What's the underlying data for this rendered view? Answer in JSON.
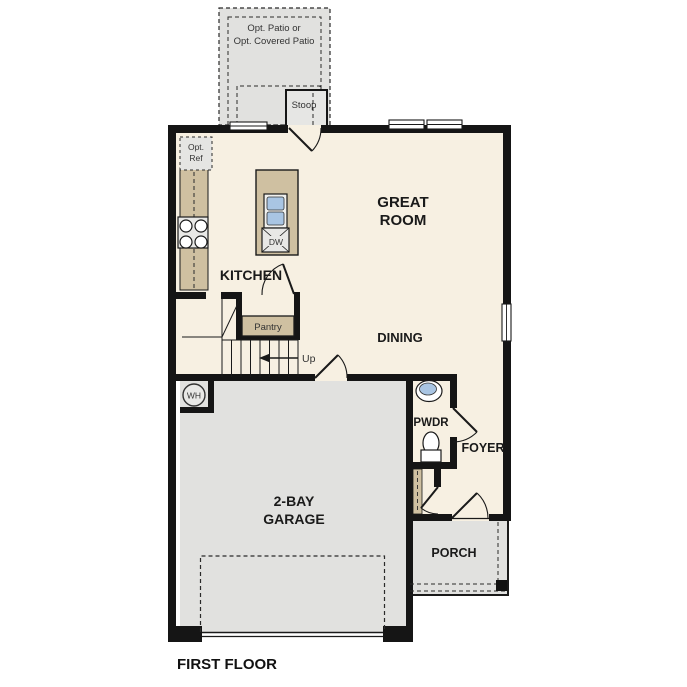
{
  "colors": {
    "bg": "#ffffff",
    "wall": "#151515",
    "floor": "#f7f0e2",
    "hard": "#e1e1df",
    "counter": "#cfc0a1",
    "sinkblue": "#a9c5e3",
    "text": "#1a1a1a",
    "smalltext": "#333333"
  },
  "plan": {
    "title": "FIRST FLOOR",
    "patio": {
      "line1": "Opt. Patio or",
      "line2": "Opt. Covered Patio"
    },
    "stoop": "Stoop",
    "opt_ref": {
      "line1": "Opt.",
      "line2": "Ref"
    },
    "kitchen": "KITCHEN",
    "great_room": {
      "line1": "GREAT",
      "line2": "ROOM"
    },
    "dining": "DINING",
    "pantry": "Pantry",
    "up": "Up",
    "dw": "DW",
    "wh": "WH",
    "pwdr": "PWDR",
    "foyer": "FOYER",
    "garage": {
      "line1": "2-BAY",
      "line2": "GARAGE"
    },
    "porch": "PORCH"
  }
}
